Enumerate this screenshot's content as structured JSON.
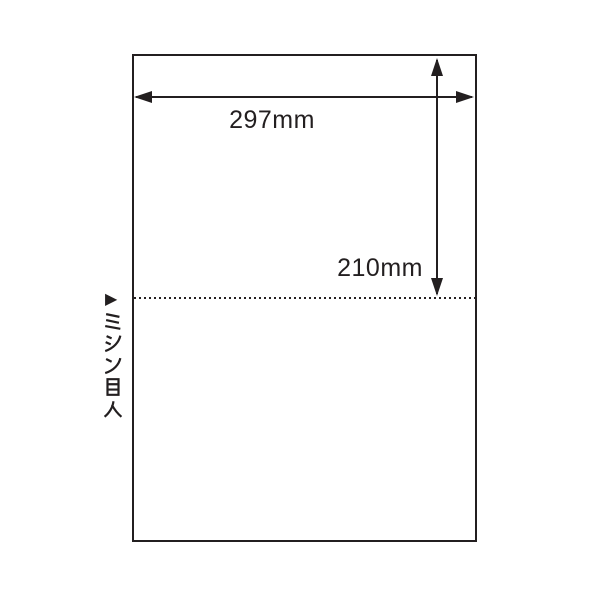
{
  "page": {
    "background_color": "#ffffff",
    "ink_color": "#231f20"
  },
  "diagram": {
    "sheet": {
      "description_width_label": "297mm",
      "description_height_label": "210mm"
    },
    "perforation": {
      "marker_icon": "▶",
      "label": "ミシン目入",
      "label_chars": [
        "ミ",
        "シ",
        "ン",
        "目",
        "入"
      ],
      "line_style": "dotted"
    }
  }
}
